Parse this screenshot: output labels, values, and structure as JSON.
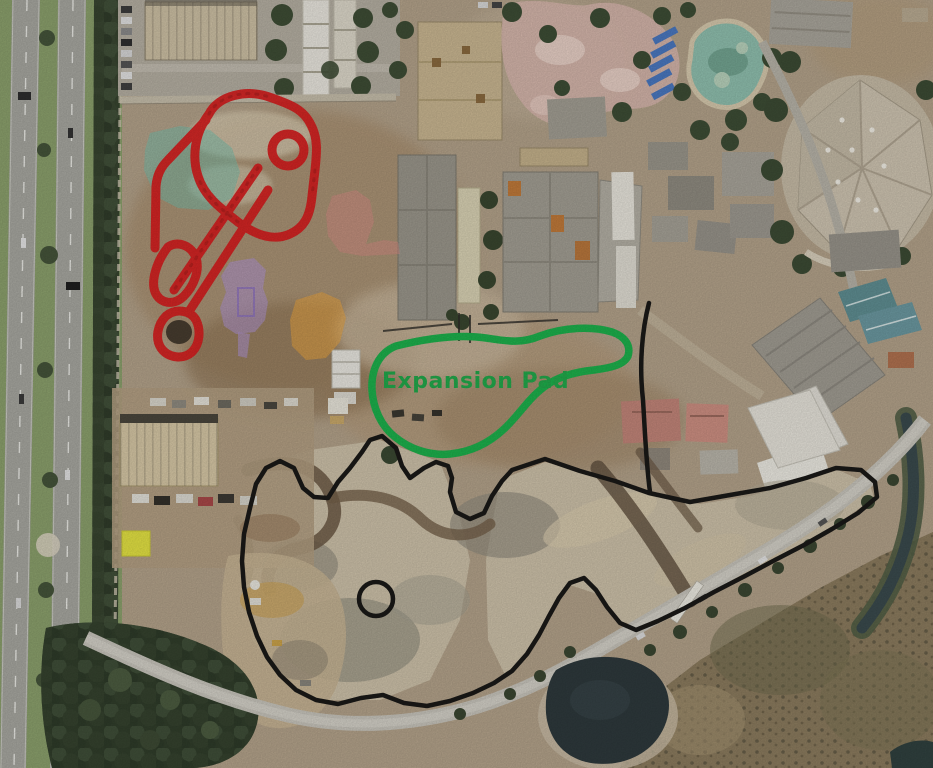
{
  "view": {
    "kind_label": "aerial construction satellite view"
  },
  "annotations": {
    "expansion_pad": {
      "label": "Expansion Pad",
      "outline_color": "#1db14c",
      "label_color": "#22a94b"
    },
    "coaster_track_outline": {
      "color": "#d62020"
    },
    "site_boundary_outline": {
      "color": "#1a1917"
    },
    "highlighted_footprints": {
      "teal": "#72bfae",
      "purple": "#b195d8",
      "orange": "#eda63e",
      "pink": "#d88b85",
      "yellow": "#e9ea3d"
    }
  }
}
